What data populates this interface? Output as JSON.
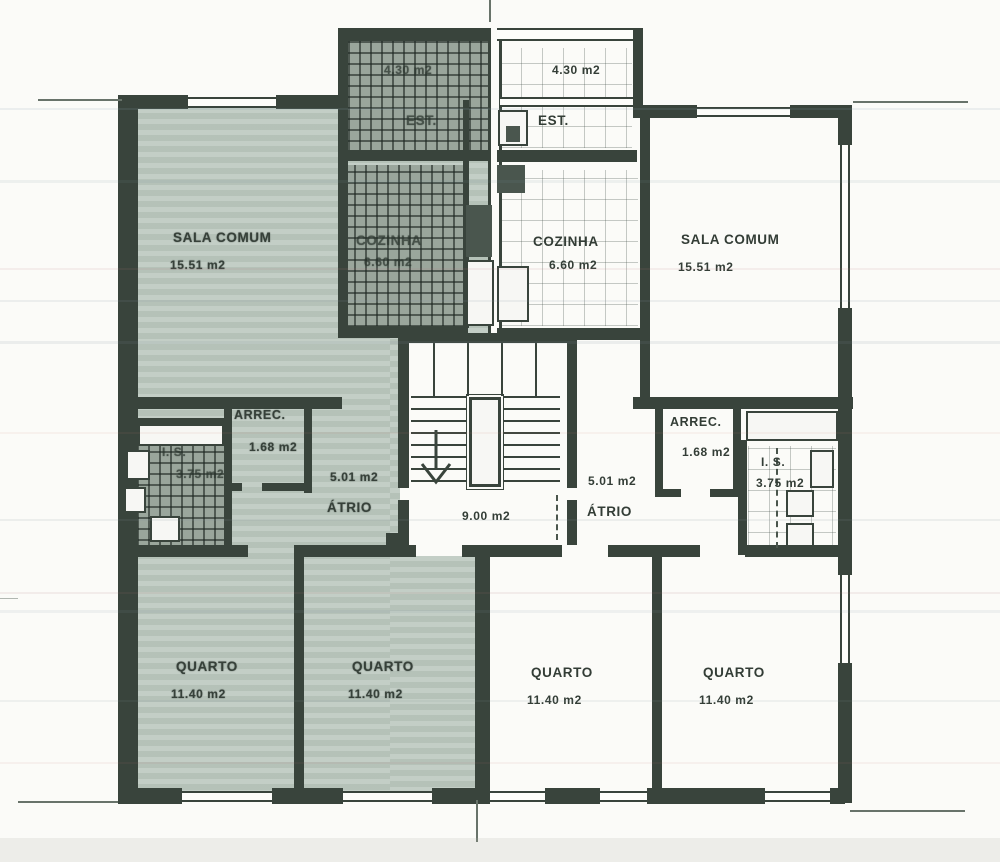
{
  "plan": {
    "stair_landing_area": "9.00 m2",
    "apartment_left": {
      "highlight_color": "#bcc8bf",
      "rooms": [
        {
          "name": "SALA COMUM",
          "area": "15.51 m2"
        },
        {
          "name": "EST.",
          "area": "4.30 m2"
        },
        {
          "name": "COZINHA",
          "area": "6.60 m2"
        },
        {
          "name": "ARREC.",
          "area": "1.68 m2"
        },
        {
          "name": "I. S.",
          "area": "3.75 m2"
        },
        {
          "name": "ÁTRIO",
          "area": "5.01 m2"
        },
        {
          "name": "QUARTO",
          "area": "11.40 m2"
        },
        {
          "name": "QUARTO",
          "area": "11.40 m2"
        }
      ]
    },
    "apartment_right": {
      "highlight_color": "#ffffff",
      "rooms": [
        {
          "name": "SALA COMUM",
          "area": "15.51 m2"
        },
        {
          "name": "EST.",
          "area": "4.30 m2"
        },
        {
          "name": "COZINHA",
          "area": "6.60 m2"
        },
        {
          "name": "ARREC.",
          "area": "1.68 m2"
        },
        {
          "name": "I. S.",
          "area": "3.75 m2"
        },
        {
          "name": "ÁTRIO",
          "area": "5.01 m2"
        },
        {
          "name": "QUARTO",
          "area": "11.40 m2"
        },
        {
          "name": "QUARTO",
          "area": "11.40 m2"
        }
      ]
    },
    "colors": {
      "line": "#39443c",
      "paper": "#fbfbf8"
    }
  }
}
